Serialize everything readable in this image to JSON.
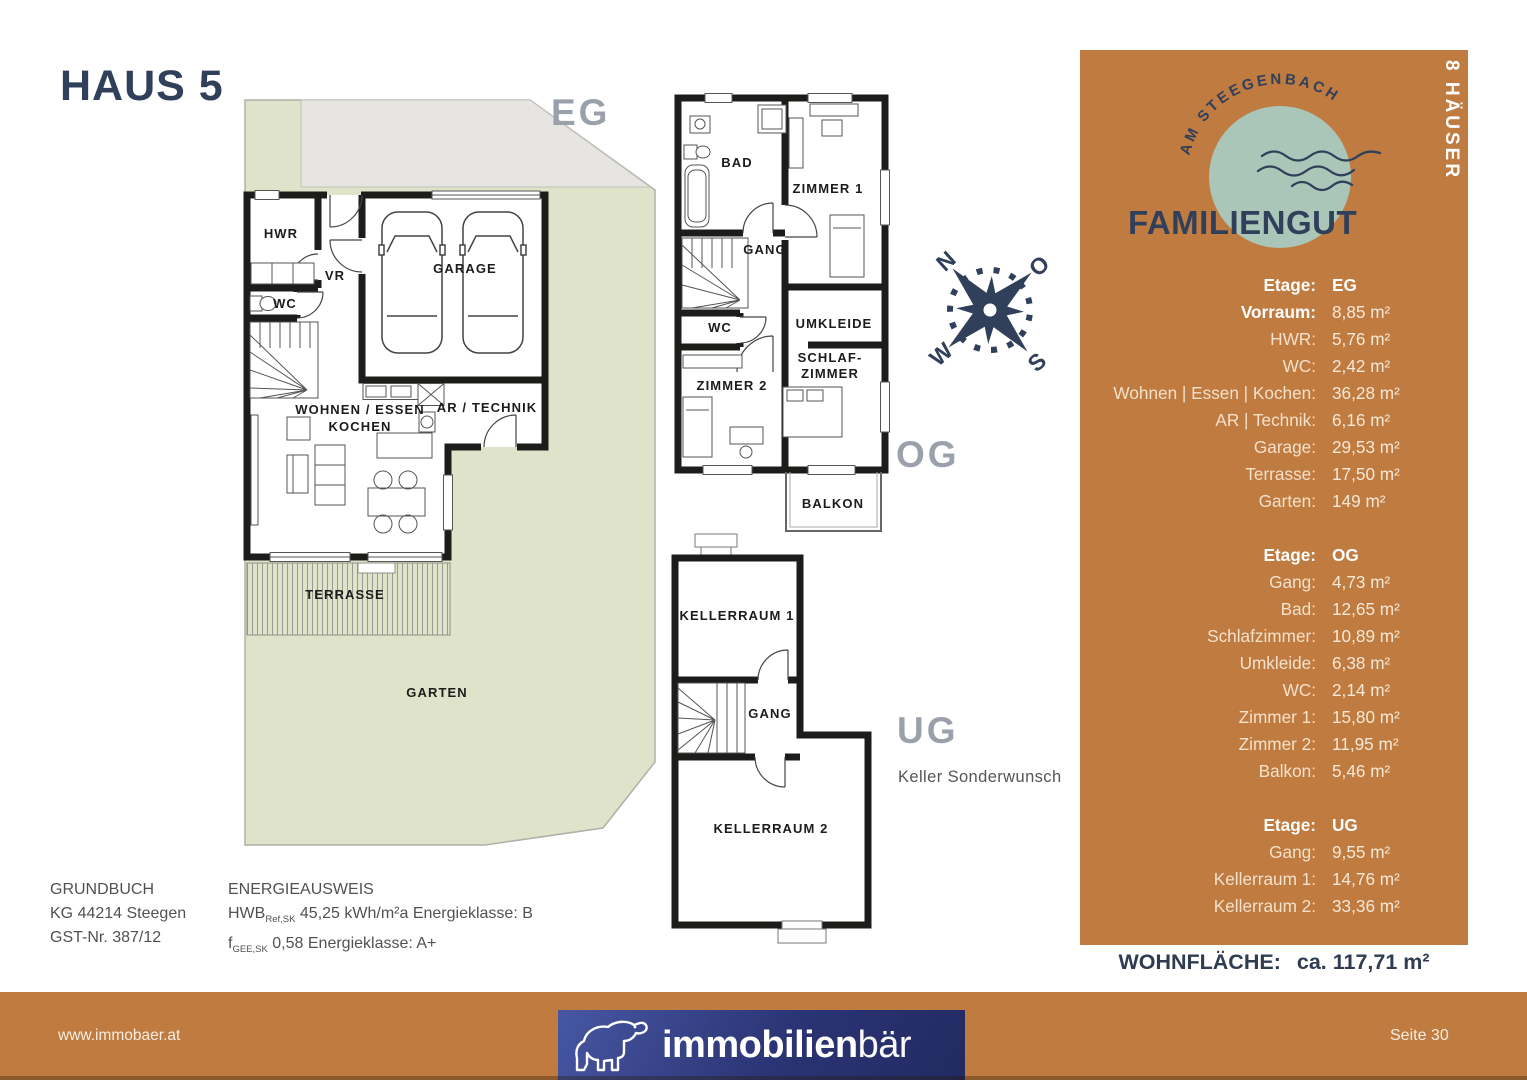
{
  "header": {
    "title": "HAUS 5"
  },
  "plans": {
    "eg": {
      "floor_label": "EG",
      "rooms": {
        "hwr": "HWR",
        "vr": "VR",
        "wc": "WC",
        "garage": "GARAGE",
        "wohnen_line1": "WOHNEN / ESSEN",
        "wohnen_line2": "KOCHEN",
        "ar_technik": "AR / TECHNIK",
        "terrasse": "TERRASSE",
        "garten": "GARTEN"
      }
    },
    "og": {
      "floor_label": "OG",
      "rooms": {
        "bad": "BAD",
        "zimmer1": "ZIMMER 1",
        "gang": "GANG",
        "wc": "WC",
        "umkleide": "UMKLEIDE",
        "zimmer2": "ZIMMER 2",
        "schlaf_line1": "SCHLAF-",
        "schlaf_line2": "ZIMMER",
        "balkon": "BALKON"
      }
    },
    "ug": {
      "floor_label": "UG",
      "note": "Keller Sonderwunsch",
      "rooms": {
        "kellerraum1": "KELLERRAUM 1",
        "gang": "GANG",
        "kellerraum2": "KELLERRAUM 2"
      }
    }
  },
  "compass": {
    "north": "N",
    "east": "O",
    "south": "S",
    "west": "W"
  },
  "brand": {
    "arc_text": "AM STEEGENBACH",
    "name": "FAMILIENGUT",
    "badge": "8 HÄUSER"
  },
  "panel": {
    "sections": [
      {
        "etage_label": "Etage:",
        "etage_value": "EG",
        "rows": [
          {
            "label": "Vorraum:",
            "value": "8,85 m²"
          },
          {
            "label": "HWR:",
            "value": "5,76 m²"
          },
          {
            "label": "WC:",
            "value": "2,42 m²"
          },
          {
            "label": "Wohnen | Essen | Kochen:",
            "value": "36,28 m²"
          },
          {
            "label": "AR | Technik:",
            "value": "6,16 m²"
          },
          {
            "label": "Garage:",
            "value": "29,53 m²"
          },
          {
            "label": "Terrasse:",
            "value": "17,50 m²"
          },
          {
            "label": "Garten:",
            "value": "149 m²"
          }
        ]
      },
      {
        "etage_label": "Etage:",
        "etage_value": "OG",
        "rows": [
          {
            "label": "Gang:",
            "value": "4,73 m²"
          },
          {
            "label": "Bad:",
            "value": "12,65 m²"
          },
          {
            "label": "Schlafzimmer:",
            "value": "10,89 m²"
          },
          {
            "label": "Umkleide:",
            "value": "6,38 m²"
          },
          {
            "label": "WC:",
            "value": "2,14 m²"
          },
          {
            "label": "Zimmer 1:",
            "value": "15,80 m²"
          },
          {
            "label": "Zimmer 2:",
            "value": "11,95 m²"
          },
          {
            "label": "Balkon:",
            "value": "5,46 m²"
          }
        ]
      },
      {
        "etage_label": "Etage:",
        "etage_value": "UG",
        "rows": [
          {
            "label": "Gang:",
            "value": "9,55 m²"
          },
          {
            "label": "Kellerraum 1:",
            "value": "14,76 m²"
          },
          {
            "label": "Kellerraum 2:",
            "value": "33,36 m²"
          }
        ]
      }
    ],
    "total_label": "WOHNFLÄCHE:",
    "total_value": "ca. 117,71 m²"
  },
  "legal": {
    "grundbuch": {
      "title": "GRUNDBUCH",
      "line1": "KG 44214 Steegen",
      "line2": "GST-Nr. 387/12"
    },
    "energie": {
      "title": "ENERGIEAUSWEIS",
      "hwb_label": "HWB",
      "hwb_sub": "Ref,SK",
      "hwb_rest": "45,25 kWh/m²a Energieklasse: B",
      "f_label": "f",
      "f_sub": "GEE,SK",
      "f_rest": "0,58 Energieklasse: A+"
    }
  },
  "footer": {
    "website": "www.immobaer.at",
    "logo_text_bold": "immobilien",
    "logo_text_light": "bär",
    "page": "Seite 30"
  },
  "colors": {
    "accent_orange": "#c07b40",
    "navy": "#31405a",
    "sage_circle": "#a9c6b8",
    "garden_green": "#dfe3c9",
    "driveway_gray": "#e6e5e1",
    "logo_blue": "#2b3474",
    "floor_tag_gray": "#9ba1ab"
  }
}
